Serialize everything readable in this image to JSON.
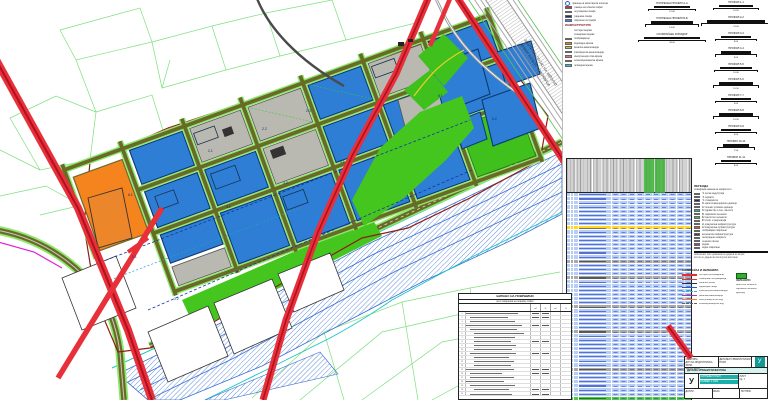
{
  "title": "детален урбанистички план - синтезен план",
  "colors": {
    "parcel_blue": "#2e7ed5",
    "parcel_gray": "#b9b9b1",
    "parcel_orange": "#f5841f",
    "green_area": "#44c61e",
    "road_red": "#e8303a",
    "river_hatch_blue": "#4a7fd8",
    "stream_cyan": "#19c5c5",
    "street_olive": "#6a6a28",
    "cadastral_green": "#7de07d",
    "table_row_blue": "#b7cdf5",
    "table_row_yellow": "#ffd91c",
    "table_row_green": "#53c94a",
    "table_section_gray": "#a9a9a9",
    "titleblock_teal": "#0f9a93",
    "plan_boundary_maroon": "#8e1d12"
  },
  "map": {
    "hw1": "ЗАШТИТЕН ПОЈАС НА АВТОПАТ",
    "hw2": "ДЕМИР КАПИЈА - СМОКВИЦА",
    "zone_labels": [
      {
        "t": "2.1",
        "x": 208,
        "y": 152
      },
      {
        "t": "2.2",
        "x": 262,
        "y": 130
      },
      {
        "t": "2.3",
        "x": 306,
        "y": 112
      },
      {
        "t": "3.1",
        "x": 226,
        "y": 208
      },
      {
        "t": "3.2",
        "x": 283,
        "y": 184
      },
      {
        "t": "4.1",
        "x": 340,
        "y": 163
      },
      {
        "t": "5.1",
        "x": 438,
        "y": 97
      },
      {
        "t": "5.2",
        "x": 492,
        "y": 120
      },
      {
        "t": "1.1",
        "x": 132,
        "y": 258
      },
      {
        "t": "1.2",
        "x": 174,
        "y": 300
      },
      {
        "t": "6.1",
        "x": 128,
        "y": 196
      }
    ]
  },
  "legend1": {
    "symbol_label": "граница на катастарска општина",
    "items": [
      {
        "c": "#d93030",
        "t": "граница на плански опфат"
      },
      {
        "c": "#2f62cf",
        "t": "регулациона линија"
      },
      {
        "c": "#12337e",
        "t": "градежна линија"
      },
      {
        "c": "#3f86e0",
        "t": "површини за градба"
      }
    ],
    "header": "ИНФРАСТРУКТУРА",
    "sub": [
      "постојни водови",
      "планирани водови"
    ],
    "items2": [
      {
        "c": "#d92020",
        "t": "сообраќајници"
      },
      {
        "c": "#f08020",
        "t": "водоводна мрежа"
      },
      {
        "c": "#c9c92a",
        "t": "фекална канализација"
      },
      {
        "c": "#e03333",
        "t": "атмосферска канализација"
      },
      {
        "c": "#ef6f6f",
        "t": "електроенергетска мрежа"
      },
      {
        "c": "#ea27c8",
        "t": "телекомуникациска мрежа"
      },
      {
        "c": "#2cc4d9",
        "t": "гасоводна мрежа"
      }
    ]
  },
  "profiles": {
    "colA": [
      {
        "label": "ПОПРЕЧЕН ПРОФИЛ А-А",
        "w": 36,
        "dim": "12.00"
      },
      {
        "label": "ПОПРЕЧЕН ПРОФИЛ Б-Б",
        "w": 42,
        "dim": "14.00"
      },
      {
        "label": "СООБРАЌАЕН КОРИДОР",
        "w": 56,
        "dim": "28.00"
      }
    ],
    "colB": [
      {
        "label": "ПРОФИЛ 1-1",
        "w": 34,
        "dim": "10.50"
      },
      {
        "label": "ПРОФИЛ 2-2",
        "w": 58,
        "dim": "21.00"
      },
      {
        "label": "ПРОФИЛ 3-3",
        "w": 30,
        "dim": "9.00"
      },
      {
        "label": "ПРОФИЛ 4-4",
        "w": 30,
        "dim": "9.00"
      },
      {
        "label": "ПРОФИЛ 5-5",
        "w": 32,
        "dim": "10.00"
      },
      {
        "label": "ПРОФИЛ 6-6",
        "w": 34,
        "dim": "10.50"
      },
      {
        "label": "ПРОФИЛ 7-7",
        "w": 30,
        "dim": "9.00"
      },
      {
        "label": "ПРОФИЛ 8-8",
        "w": 34,
        "dim": "10.50"
      },
      {
        "label": "ПРОФИЛ 9-9",
        "w": 30,
        "dim": "9.00"
      },
      {
        "label": "ПРОФИЛ 10-10",
        "w": 26,
        "dim": "7.50"
      },
      {
        "label": "ПРОФИЛ 11-11",
        "w": 30,
        "dim": "9.00"
      }
    ]
  },
  "main_table": {
    "row_types": "bbbbbbbbybbbbbbbsbbbsbbbbbbsbbbbbsbbbbbbbbsbbbbbbG"
  },
  "legend2": {
    "title": "ЛЕГЕНДА",
    "subtitle": "планирана намена на земјиштето",
    "items": [
      {
        "c": "#c03020",
        "t": "Г2 лесна индустрија"
      },
      {
        "c": "#2060c0",
        "t": "Г3 сервиси"
      },
      {
        "c": "#103070",
        "t": "Г4 стоваришта"
      },
      {
        "c": "#2080e0",
        "t": "Б1 мали комерцијални единици"
      },
      {
        "c": "#70b0f0",
        "t": "Б2 големи трговски единици"
      },
      {
        "c": "#20b0b0",
        "t": "В2 здравство и соц. заштита"
      },
      {
        "c": "#107040",
        "t": "Д1 парковско зеленило"
      },
      {
        "c": "#40c040",
        "t": "Д2 заштитно зеленило"
      },
      {
        "c": "#a0e060",
        "t": "Д3 спорт и рекреација"
      },
      {
        "c": "#f0a020",
        "t": "Е1 комунална инфраструктура"
      },
      {
        "c": "#d06010",
        "t": "Е2 комунална супраструктура"
      },
      {
        "c": "#909090",
        "t": "сообраќајни површини"
      },
      {
        "c": "#404040",
        "t": "железничка инфраструктура"
      },
      {
        "c": "#f8f8f8",
        "t": "неизградено земјиште"
      },
      {
        "c": "#e0e040",
        "t": "пешачки патеки"
      },
      {
        "c": "#b030b0",
        "t": "водови"
      },
      {
        "c": "#30c0f0",
        "t": "водни површини"
      }
    ],
    "notes": [
      "забелешка: сите димензии се дадени во метри",
      "котите се дадени во апсолутни височини"
    ]
  },
  "legend3": {
    "title": "СООБРАЌАЈ И ЗЕЛЕНИЛО",
    "left": [
      {
        "c": "#e03030",
        "w": 2.6,
        "d": 0,
        "t": "постојна сообраќајница"
      },
      {
        "c": "#e03030",
        "w": 1.2,
        "d": 0,
        "t": "планирана сообраќајница"
      },
      {
        "c": "#303030",
        "w": 1,
        "d": 0,
        "t": "пешачка патека"
      },
      {
        "c": "#2060c0",
        "w": 1,
        "d": 0,
        "t": "водоводна линија"
      },
      {
        "c": "#20c0c0",
        "w": 1,
        "d": 1,
        "t": "атмосферска канализација"
      },
      {
        "c": "#b030b0",
        "w": 1,
        "d": 0,
        "t": "фекална канализација"
      },
      {
        "c": "#f08020",
        "w": 1,
        "d": 0,
        "t": "електроенергетски вод"
      },
      {
        "c": "#606060",
        "w": 1,
        "d": 1,
        "t": "телекомуникациски вод"
      }
    ],
    "right_title": "ЗЕЛЕНИЛО",
    "right": [
      "заштитно зеленило",
      "парковско зеленило",
      "дрворед"
    ]
  },
  "balance": {
    "title": "БИЛАНС НА ПОВРШИНИ",
    "subtitle": "нето површина на плански опфат",
    "col_headers": [
      "м²",
      "%",
      "м²",
      "%"
    ],
    "rows": [
      {
        "w": 82,
        "i": 0,
        "v": 1
      },
      {
        "w": 60,
        "i": 1,
        "v": 1
      },
      {
        "w": 70,
        "i": 1,
        "v": 0
      },
      {
        "w": 88,
        "i": 0,
        "v": 1
      },
      {
        "w": 74,
        "i": 1,
        "v": 0
      },
      {
        "w": 78,
        "i": 2,
        "v": 0
      },
      {
        "w": 64,
        "i": 2,
        "v": 0
      },
      {
        "w": 58,
        "i": 2,
        "v": 1
      },
      {
        "w": 66,
        "i": 2,
        "v": 0
      },
      {
        "w": 60,
        "i": 2,
        "v": 0
      },
      {
        "w": 72,
        "i": 1,
        "v": 1
      },
      {
        "w": 55,
        "i": 2,
        "v": 0
      },
      {
        "w": 62,
        "i": 2,
        "v": 0
      },
      {
        "w": 58,
        "i": 2,
        "v": 0
      },
      {
        "w": 75,
        "i": 0,
        "v": 1
      },
      {
        "w": 50,
        "i": 1,
        "v": 1
      },
      {
        "w": 68,
        "i": 1,
        "v": 0
      },
      {
        "w": 60,
        "i": 0,
        "v": 0
      },
      {
        "w": 70,
        "i": 1,
        "v": 0
      },
      {
        "w": 55,
        "i": 2,
        "v": 1
      },
      {
        "w": 65,
        "i": 1,
        "v": 1
      }
    ]
  },
  "titleblock": {
    "org_lines": [
      "ОПШТИНА",
      "ДУП ЗА ИНДУСТРИСКА ЗОНА",
      "тех.бр. 04/18"
    ],
    "row2": "ДЕТАЛЕН УРБАНИСТИЧКИ ПЛАН",
    "symbol": "У",
    "teal_rows": [
      "СИНТЕЗЕН ПЛАН",
      "РАЗМЕР 1:1000"
    ],
    "right_lines": [
      "ЛИСТ",
      "бр. 7"
    ],
    "bottom": [
      "ДАТУМ",
      "ФАЗА",
      "ПОТПИС"
    ],
    "logo_glyph": "У"
  }
}
